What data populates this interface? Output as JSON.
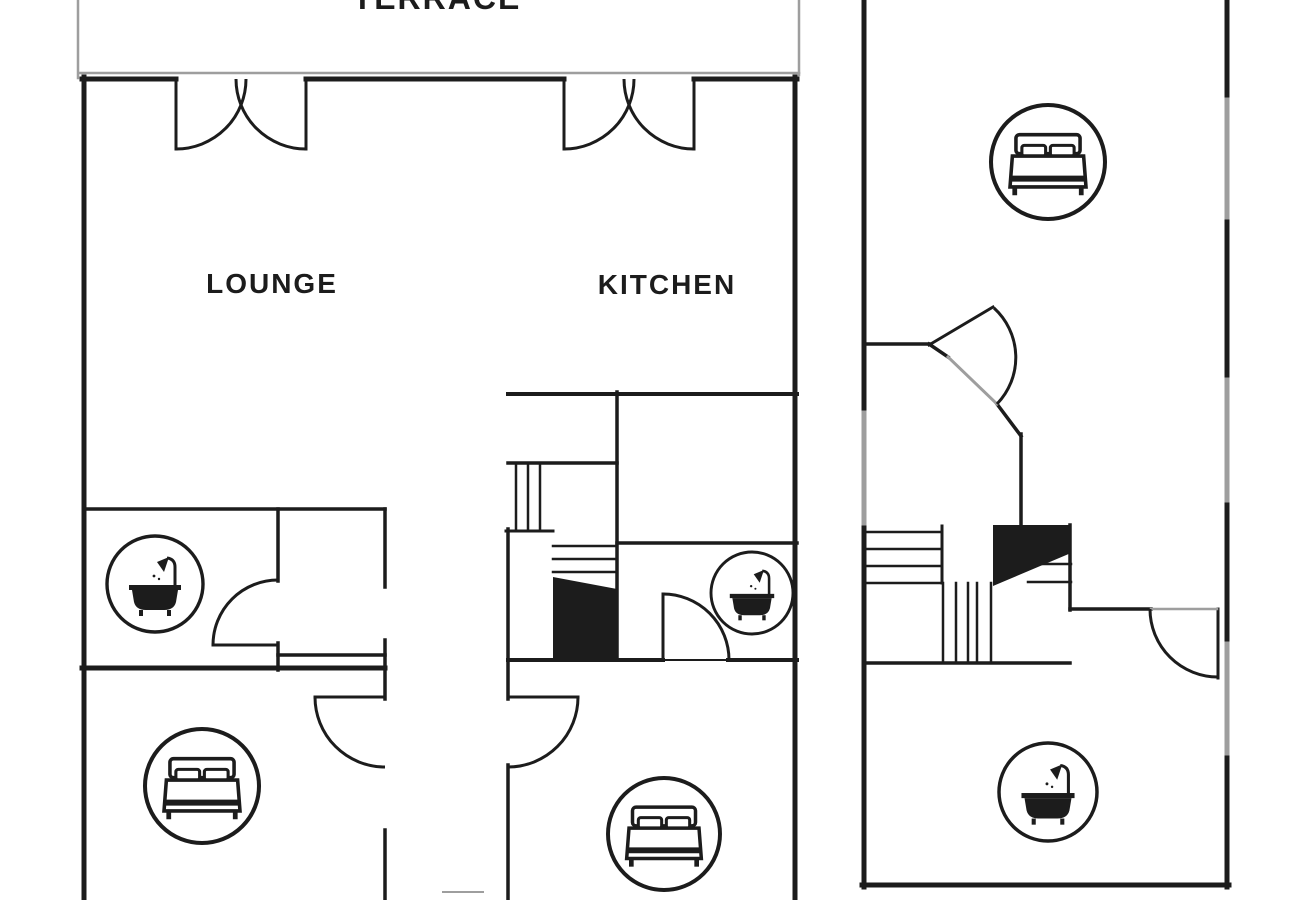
{
  "meta": {
    "width": 1300,
    "height": 900,
    "title": "floor-plan"
  },
  "colors": {
    "line": "#1c1c1c",
    "window": "#9e9e9e",
    "bg": "#ffffff"
  },
  "labels": [
    {
      "name": "terrace",
      "text": "TERRACE",
      "x": 437,
      "y": 9,
      "size": 32,
      "spacing": 2
    },
    {
      "name": "lounge",
      "text": "LOUNGE",
      "x": 272,
      "y": 293,
      "size": 28,
      "spacing": 2
    },
    {
      "name": "kitchen",
      "text": "KITCHEN",
      "x": 667,
      "y": 294,
      "size": 28,
      "spacing": 2
    }
  ],
  "plan": {
    "walls": [
      [
        82,
        79,
        176,
        79,
        5
      ],
      [
        306,
        79,
        564,
        79,
        5
      ],
      [
        694,
        79,
        797,
        79,
        5
      ],
      [
        84,
        77,
        84,
        900,
        5
      ],
      [
        795,
        77,
        795,
        900,
        5
      ],
      [
        176,
        79,
        176,
        149,
        3
      ],
      [
        306,
        79,
        306,
        149,
        3
      ],
      [
        564,
        79,
        564,
        149,
        3
      ],
      [
        694,
        79,
        694,
        149,
        3
      ],
      [
        508,
        394,
        797,
        394,
        4
      ],
      [
        617,
        392,
        617,
        660,
        3.5
      ],
      [
        508,
        463,
        617,
        463,
        3.5
      ],
      [
        516,
        463,
        516,
        531,
        2.5
      ],
      [
        528,
        463,
        528,
        531,
        2.5
      ],
      [
        540,
        463,
        540,
        531,
        2.5
      ],
      [
        506,
        531,
        553,
        531,
        3
      ],
      [
        508,
        529,
        508,
        699,
        3.5
      ],
      [
        553,
        546,
        617,
        546,
        2.5
      ],
      [
        553,
        559,
        617,
        559,
        2.5
      ],
      [
        553,
        572,
        617,
        572,
        2.5
      ],
      [
        508,
        660,
        663,
        660,
        4
      ],
      [
        663,
        660,
        728,
        660,
        2
      ],
      [
        728,
        660,
        797,
        660,
        4
      ],
      [
        617,
        543,
        797,
        543,
        3.5
      ],
      [
        663,
        594,
        663,
        660,
        3
      ],
      [
        84,
        509,
        385,
        509,
        3.5
      ],
      [
        278,
        509,
        278,
        581,
        3.5
      ],
      [
        213,
        645,
        278,
        645,
        3
      ],
      [
        278,
        643,
        278,
        670,
        3.5
      ],
      [
        82,
        668,
        385,
        668,
        5
      ],
      [
        385,
        509,
        385,
        587,
        3.5
      ],
      [
        385,
        640,
        385,
        699,
        3.5
      ],
      [
        278,
        655,
        385,
        655,
        3.5
      ],
      [
        315,
        697,
        385,
        697,
        3
      ],
      [
        385,
        830,
        385,
        900,
        3.5
      ],
      [
        508,
        697,
        578,
        697,
        3
      ],
      [
        508,
        765,
        508,
        900,
        3.5
      ],
      [
        864,
        0,
        864,
        413,
        5
      ],
      [
        864,
        523,
        864,
        887,
        5
      ],
      [
        1227,
        0,
        1227,
        100,
        5
      ],
      [
        1227,
        217,
        1227,
        380,
        5
      ],
      [
        1227,
        500,
        1227,
        644,
        5
      ],
      [
        1227,
        753,
        1227,
        887,
        5
      ],
      [
        862,
        885,
        1229,
        885,
        5
      ],
      [
        864,
        344,
        929,
        344,
        3.5
      ],
      [
        929,
        344,
        948,
        357,
        3.5
      ],
      [
        929,
        345,
        993,
        307,
        3
      ],
      [
        997,
        404,
        1021,
        436,
        3.5
      ],
      [
        1021,
        434,
        1021,
        527,
        3.5
      ],
      [
        1012,
        564,
        1071,
        564,
        2.5
      ],
      [
        1028,
        582,
        1071,
        582,
        2.5
      ],
      [
        1070,
        525,
        1070,
        610,
        3.5
      ],
      [
        1070,
        609,
        1151,
        609,
        3.5
      ],
      [
        1218,
        609,
        1218,
        678,
        3
      ],
      [
        864,
        532,
        942,
        532,
        2.5
      ],
      [
        864,
        549,
        942,
        549,
        2.5
      ],
      [
        864,
        566,
        942,
        566,
        2.5
      ],
      [
        864,
        583,
        942,
        583,
        2.5
      ],
      [
        942,
        526,
        942,
        583,
        3
      ],
      [
        943,
        583,
        943,
        663,
        2.5
      ],
      [
        956,
        583,
        956,
        663,
        2.5
      ],
      [
        968,
        583,
        968,
        663,
        2.5
      ],
      [
        977,
        583,
        977,
        663,
        2.5
      ],
      [
        991,
        583,
        991,
        663,
        2.5
      ],
      [
        864,
        663,
        1070,
        663,
        3.5
      ]
    ],
    "windows": [
      [
        78,
        0,
        78,
        78,
        2.5
      ],
      [
        799,
        0,
        799,
        75,
        2.5
      ],
      [
        80,
        73,
        799,
        73,
        2.5
      ],
      [
        864,
        413,
        864,
        523,
        5
      ],
      [
        1227,
        100,
        1227,
        217,
        5
      ],
      [
        1227,
        380,
        1227,
        500,
        5
      ],
      [
        1227,
        644,
        1227,
        753,
        5
      ],
      [
        948,
        357,
        997,
        404,
        3
      ],
      [
        1151,
        609,
        1217,
        609,
        2.5
      ],
      [
        443,
        892,
        483,
        892,
        2
      ]
    ],
    "arcs": [
      "M246,79 A70,70 0 0 1 176,149",
      "M236,79 A70,70 0 0 0 306,149",
      "M634,79 A70,70 0 0 1 564,149",
      "M624,79 A70,70 0 0 0 694,149",
      "M663,594 A66,66 0 0 1 729,660",
      "M213,645 A65,65 0 0 1 278,580",
      "M315,697 A70,70 0 0 0 385,767",
      "M578,697 A70,70 0 0 1 508,767",
      "M994,308 A67,67 0 0 1 997,404",
      "M1150,609 A68,68 0 0 0 1218,677"
    ],
    "fills": [
      "993,525 1071,525 1071,553 993,586",
      "553,577 617,589 617,658 553,658"
    ],
    "icons": [
      {
        "type": "bed",
        "cx": 202,
        "cy": 786,
        "r": 57
      },
      {
        "type": "bed",
        "cx": 664,
        "cy": 834,
        "r": 56
      },
      {
        "type": "bed",
        "cx": 1048,
        "cy": 162,
        "r": 57
      },
      {
        "type": "bath",
        "cx": 155,
        "cy": 584,
        "r": 48
      },
      {
        "type": "bath",
        "cx": 752,
        "cy": 593,
        "r": 41
      },
      {
        "type": "bath",
        "cx": 1048,
        "cy": 792,
        "r": 49
      }
    ]
  }
}
